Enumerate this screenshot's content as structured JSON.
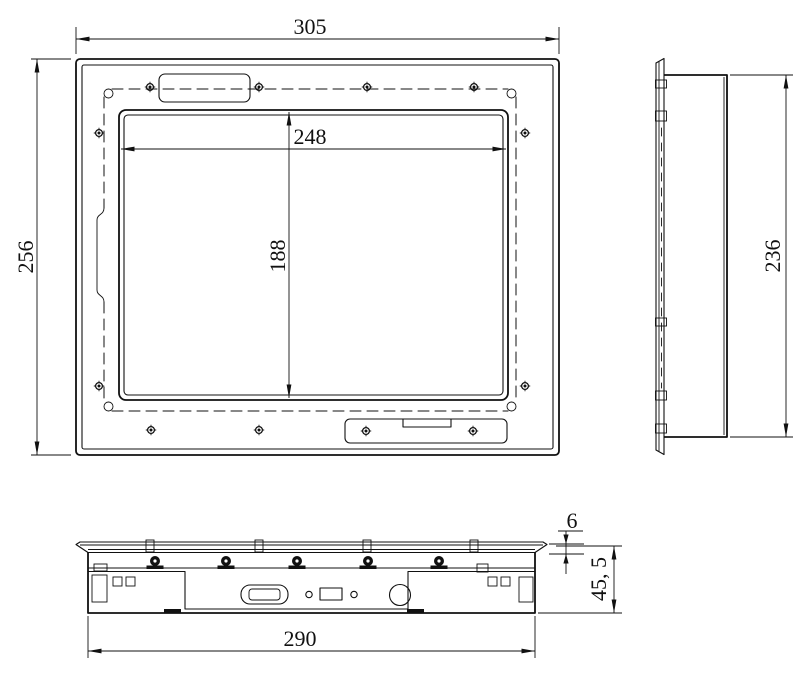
{
  "drawing": {
    "front": {
      "width": "305",
      "height": "256",
      "display_width": "248",
      "display_height": "188"
    },
    "side": {
      "height": "236"
    },
    "bottom": {
      "width": "290",
      "height": "45, 5",
      "bezel": "6"
    }
  },
  "colors": {
    "line": "#111111",
    "background": "#ffffff"
  }
}
